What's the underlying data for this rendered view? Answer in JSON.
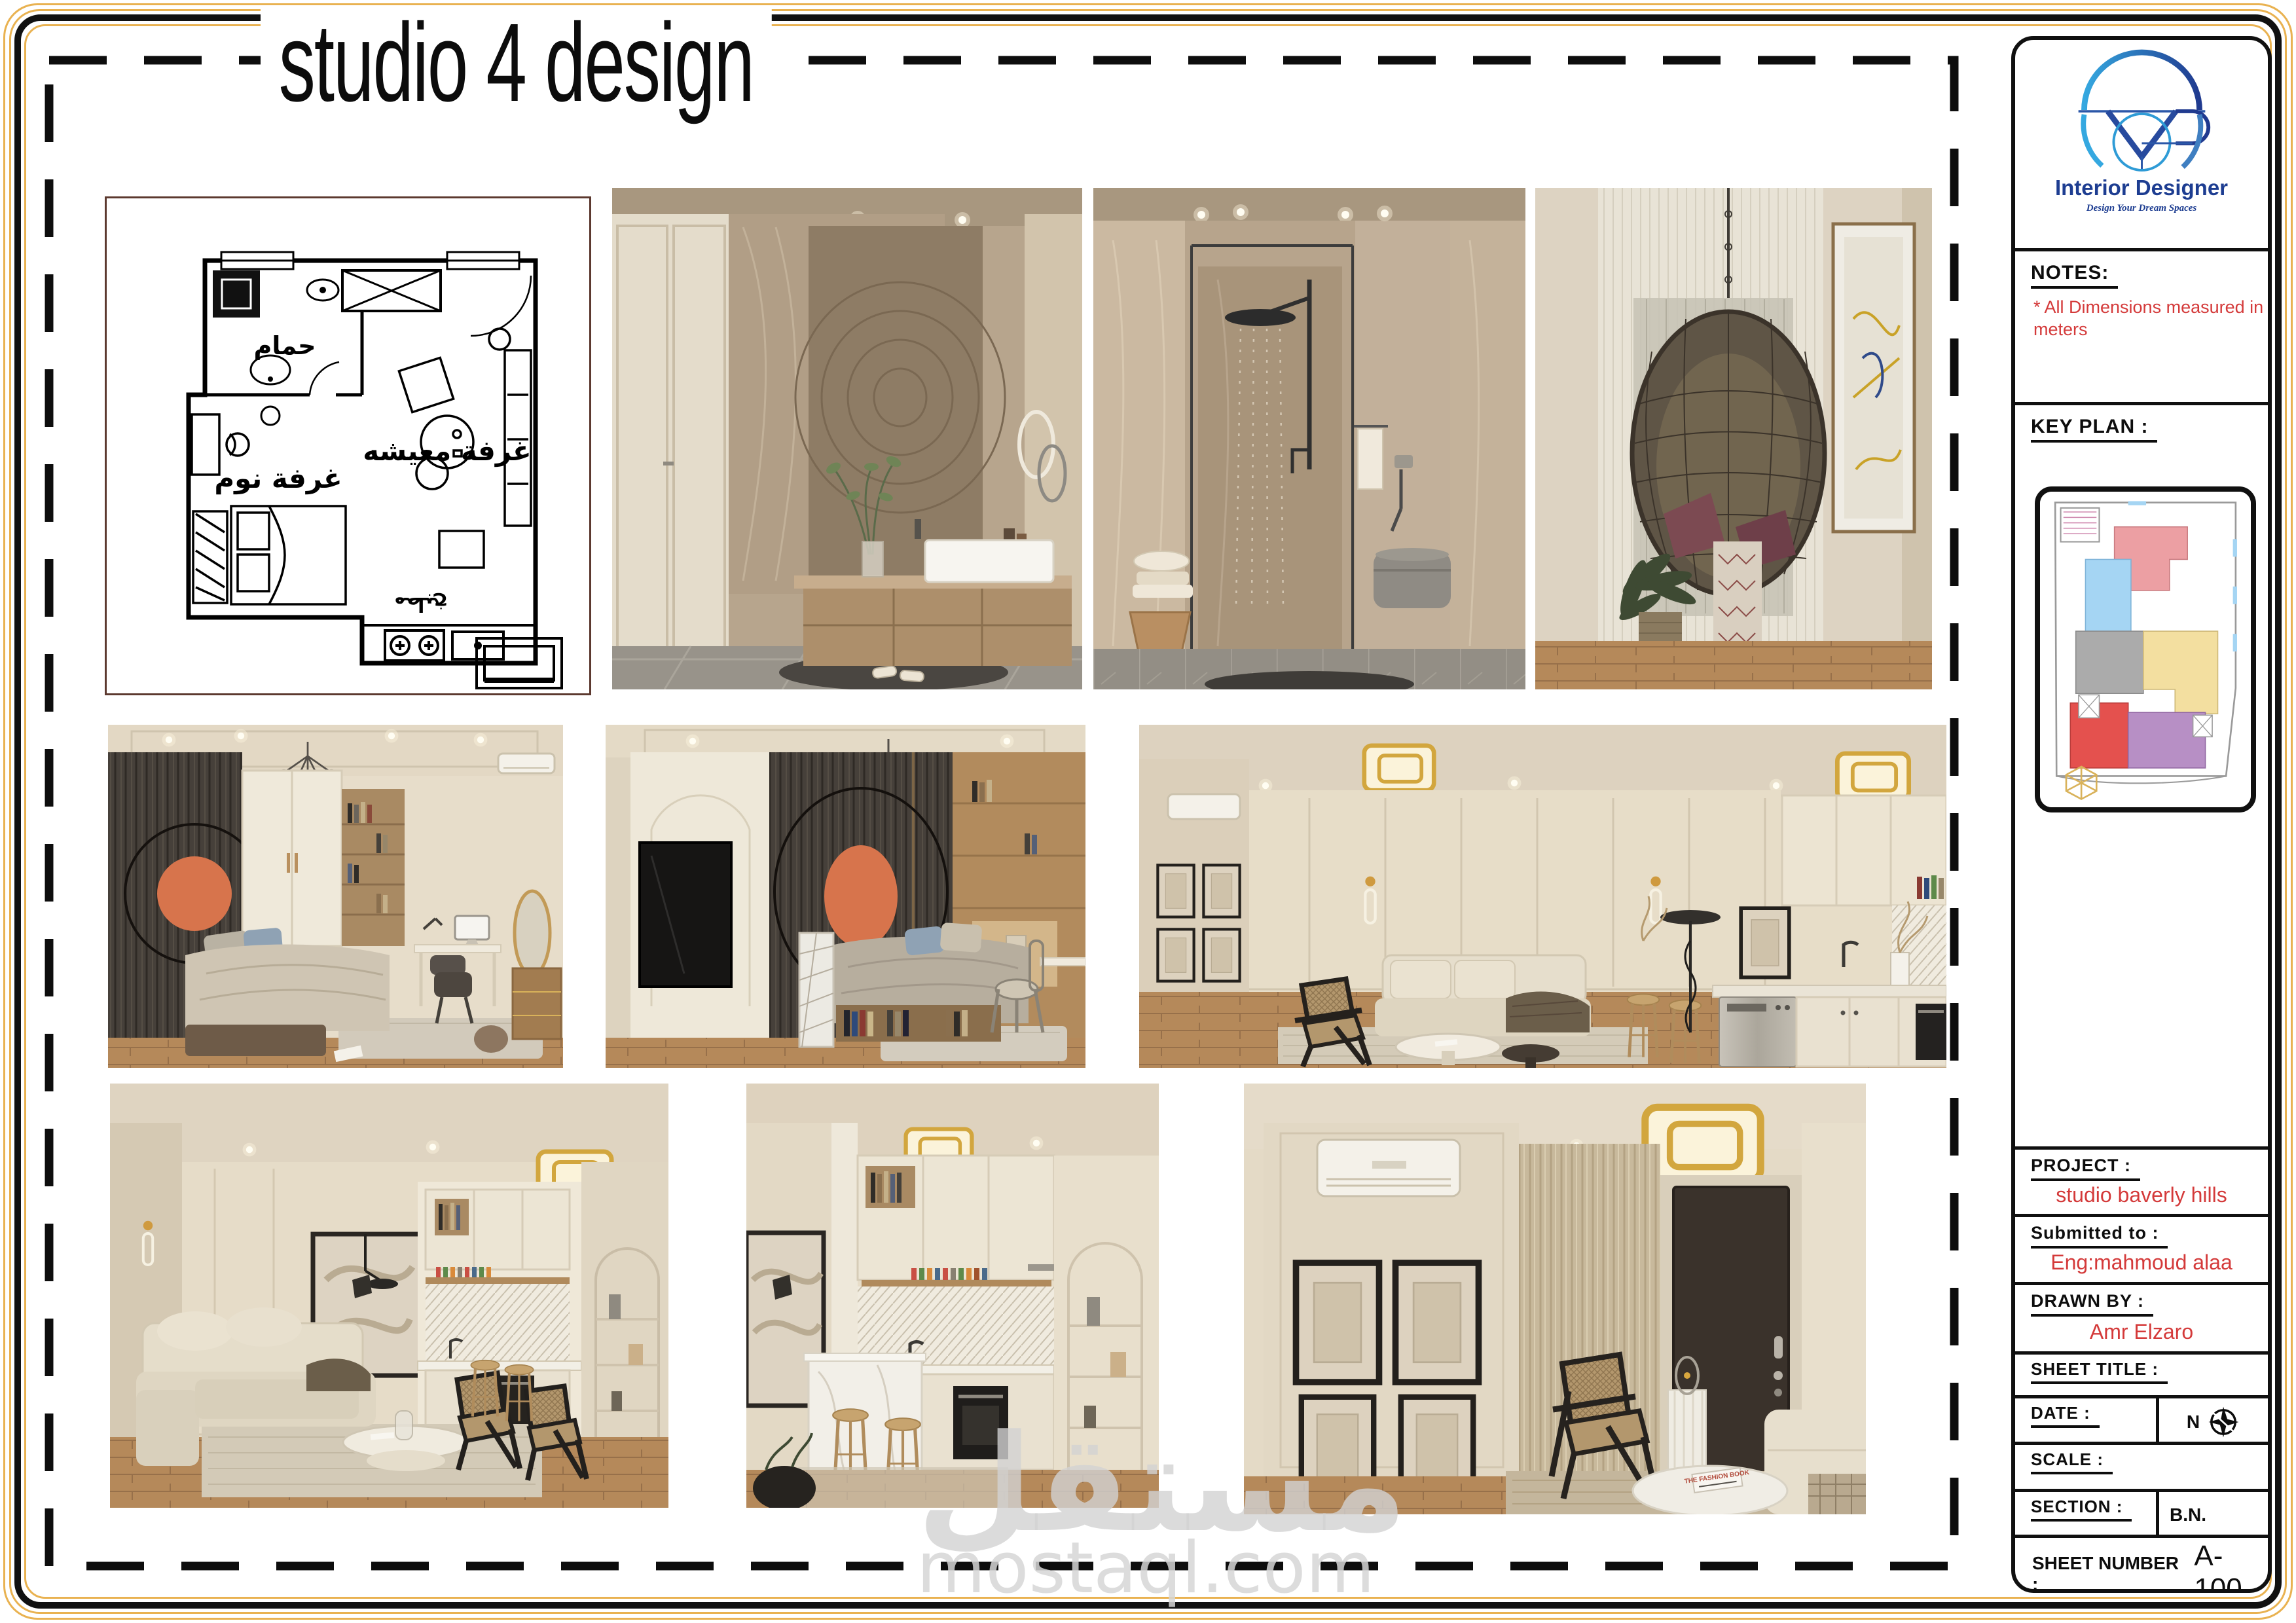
{
  "sheet": {
    "title": "studio 4 design"
  },
  "watermark": {
    "arabic": "مستقل",
    "domain": "mostaql.com"
  },
  "titleblock": {
    "brand": {
      "name": "Interior Designer",
      "tagline": "Design Your Dream Spaces"
    },
    "notes": {
      "label": "NOTES:",
      "items": [
        "* All Dimensions measured in meters"
      ]
    },
    "key_plan": {
      "label": "KEY PLAN :"
    },
    "project": {
      "label": "PROJECT :",
      "value": "studio baverly hills"
    },
    "submitted_to": {
      "label": "Submitted to :",
      "value": "Eng:mahmoud alaa"
    },
    "drawn_by": {
      "label": "DRAWN BY :",
      "value": "Amr Elzaro"
    },
    "sheet_title": {
      "label": "SHEET TITLE :"
    },
    "date": {
      "label": "DATE :",
      "north_label": "N"
    },
    "scale": {
      "label": "SCALE :"
    },
    "section": {
      "label": "SECTION :",
      "value": "B.N."
    },
    "sheet_number": {
      "label": "SHEET NUMBER :",
      "value": "A-100"
    }
  },
  "floorplan_labels": {
    "bathroom": "حمام",
    "bedroom": "غرفة نوم",
    "living": "غرفة معيشه",
    "kitchen": "مطبخ"
  },
  "entry_scene": {
    "book_title": "THE FASHION BOOK"
  },
  "colors": {
    "frame_gold": "#e9b251",
    "accent_red": "#d43a3a",
    "logo_navy": "#1d3d91",
    "logo_blue": "#2e9bd6",
    "key_plan_rooms": [
      "#ec9fa3",
      "#a5d5f3",
      "#ababab",
      "#f3dfa0",
      "#e4514e",
      "#b78fc5"
    ]
  }
}
